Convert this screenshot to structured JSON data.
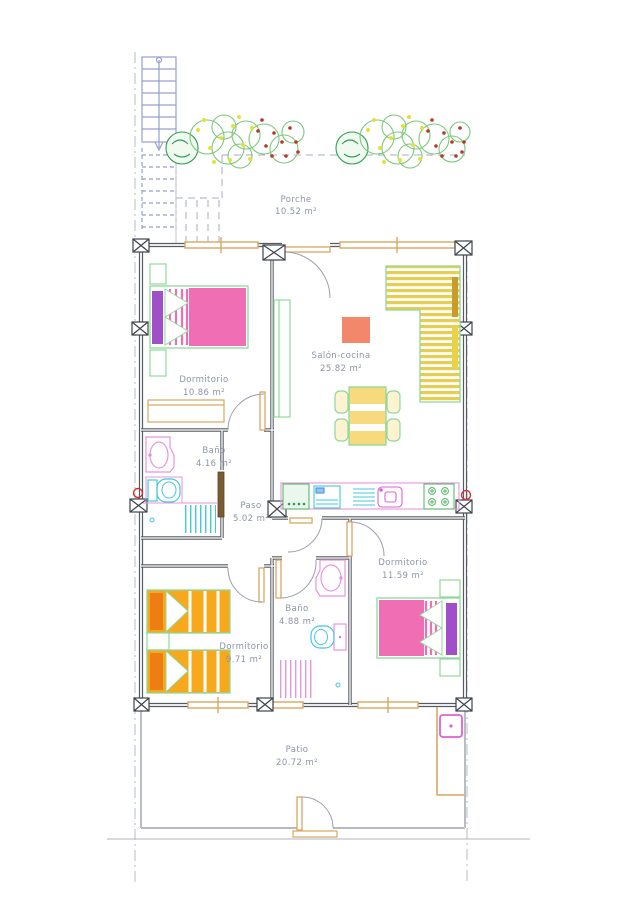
{
  "drawing": {
    "kind": "apartment floor plan",
    "rooms": [
      {
        "id": "porche",
        "name": "Porche",
        "area": "10.52 m²"
      },
      {
        "id": "dormitorio-principal",
        "name": "Dormitorio",
        "area": "10.86 m²"
      },
      {
        "id": "salon-cocina",
        "name": "Salón-cocina",
        "area": "25.82 m²"
      },
      {
        "id": "bano-1",
        "name": "Baño",
        "area": "4.16 m²"
      },
      {
        "id": "paso",
        "name": "Paso",
        "area": "5.02 m²"
      },
      {
        "id": "dormitorio-2",
        "name": "Dormitorio",
        "area": "11.59 m²"
      },
      {
        "id": "bano-2",
        "name": "Baño",
        "area": "4.88 m²"
      },
      {
        "id": "dormitorio-3",
        "name": "Dormitorio",
        "area": "9.71 m²"
      },
      {
        "id": "patio",
        "name": "Patio",
        "area": "20.72 m²"
      }
    ],
    "icons": [
      "staircase-icon",
      "bush-icon",
      "double-bed-icon",
      "twin-bed-icon",
      "nightstand-icon",
      "wardrobe-icon",
      "sideboard-icon",
      "sofa-l-icon",
      "rug-icon",
      "dining-table-icon",
      "chair-icon",
      "kitchen-counter-icon",
      "fridge-icon",
      "dishwasher-icon",
      "sink-icon",
      "stove-icon",
      "washbasin-icon",
      "toilet-icon",
      "shower-icon",
      "door-swing-icon",
      "window-icon",
      "column-marker-icon",
      "plumbing-riser-icon",
      "water-heater-icon"
    ],
    "colors": {
      "wall_gray": "#5d626b",
      "thin_gray": "#9aa0ad",
      "text_slate": "#8b94a6",
      "stair_blue": "#98a0cc",
      "wood_tan": "#d9a760",
      "door_brown": "#7a5c32",
      "bed_pink": "#f06eb4",
      "pillow_purple": "#a04fc9",
      "bed_orange": "#f7a81b",
      "pillow_orange": "#ee7d13",
      "sofa_yellow": "#e7ce4e",
      "cushion_brown": "#c99b2c",
      "table_yellow": "#f7d97e",
      "rug_salmon": "#f3876b",
      "furniture_green": "#8fd89a",
      "fixture_magenta": "#e060d0",
      "fixture_cyan": "#45c8d8",
      "bush_green": "#7cc87c",
      "bush_dark_green": "#2f9e4f",
      "dot_yellow": "#e3e23c",
      "dot_red": "#b5372a",
      "riser_red": "#cc3333"
    }
  }
}
